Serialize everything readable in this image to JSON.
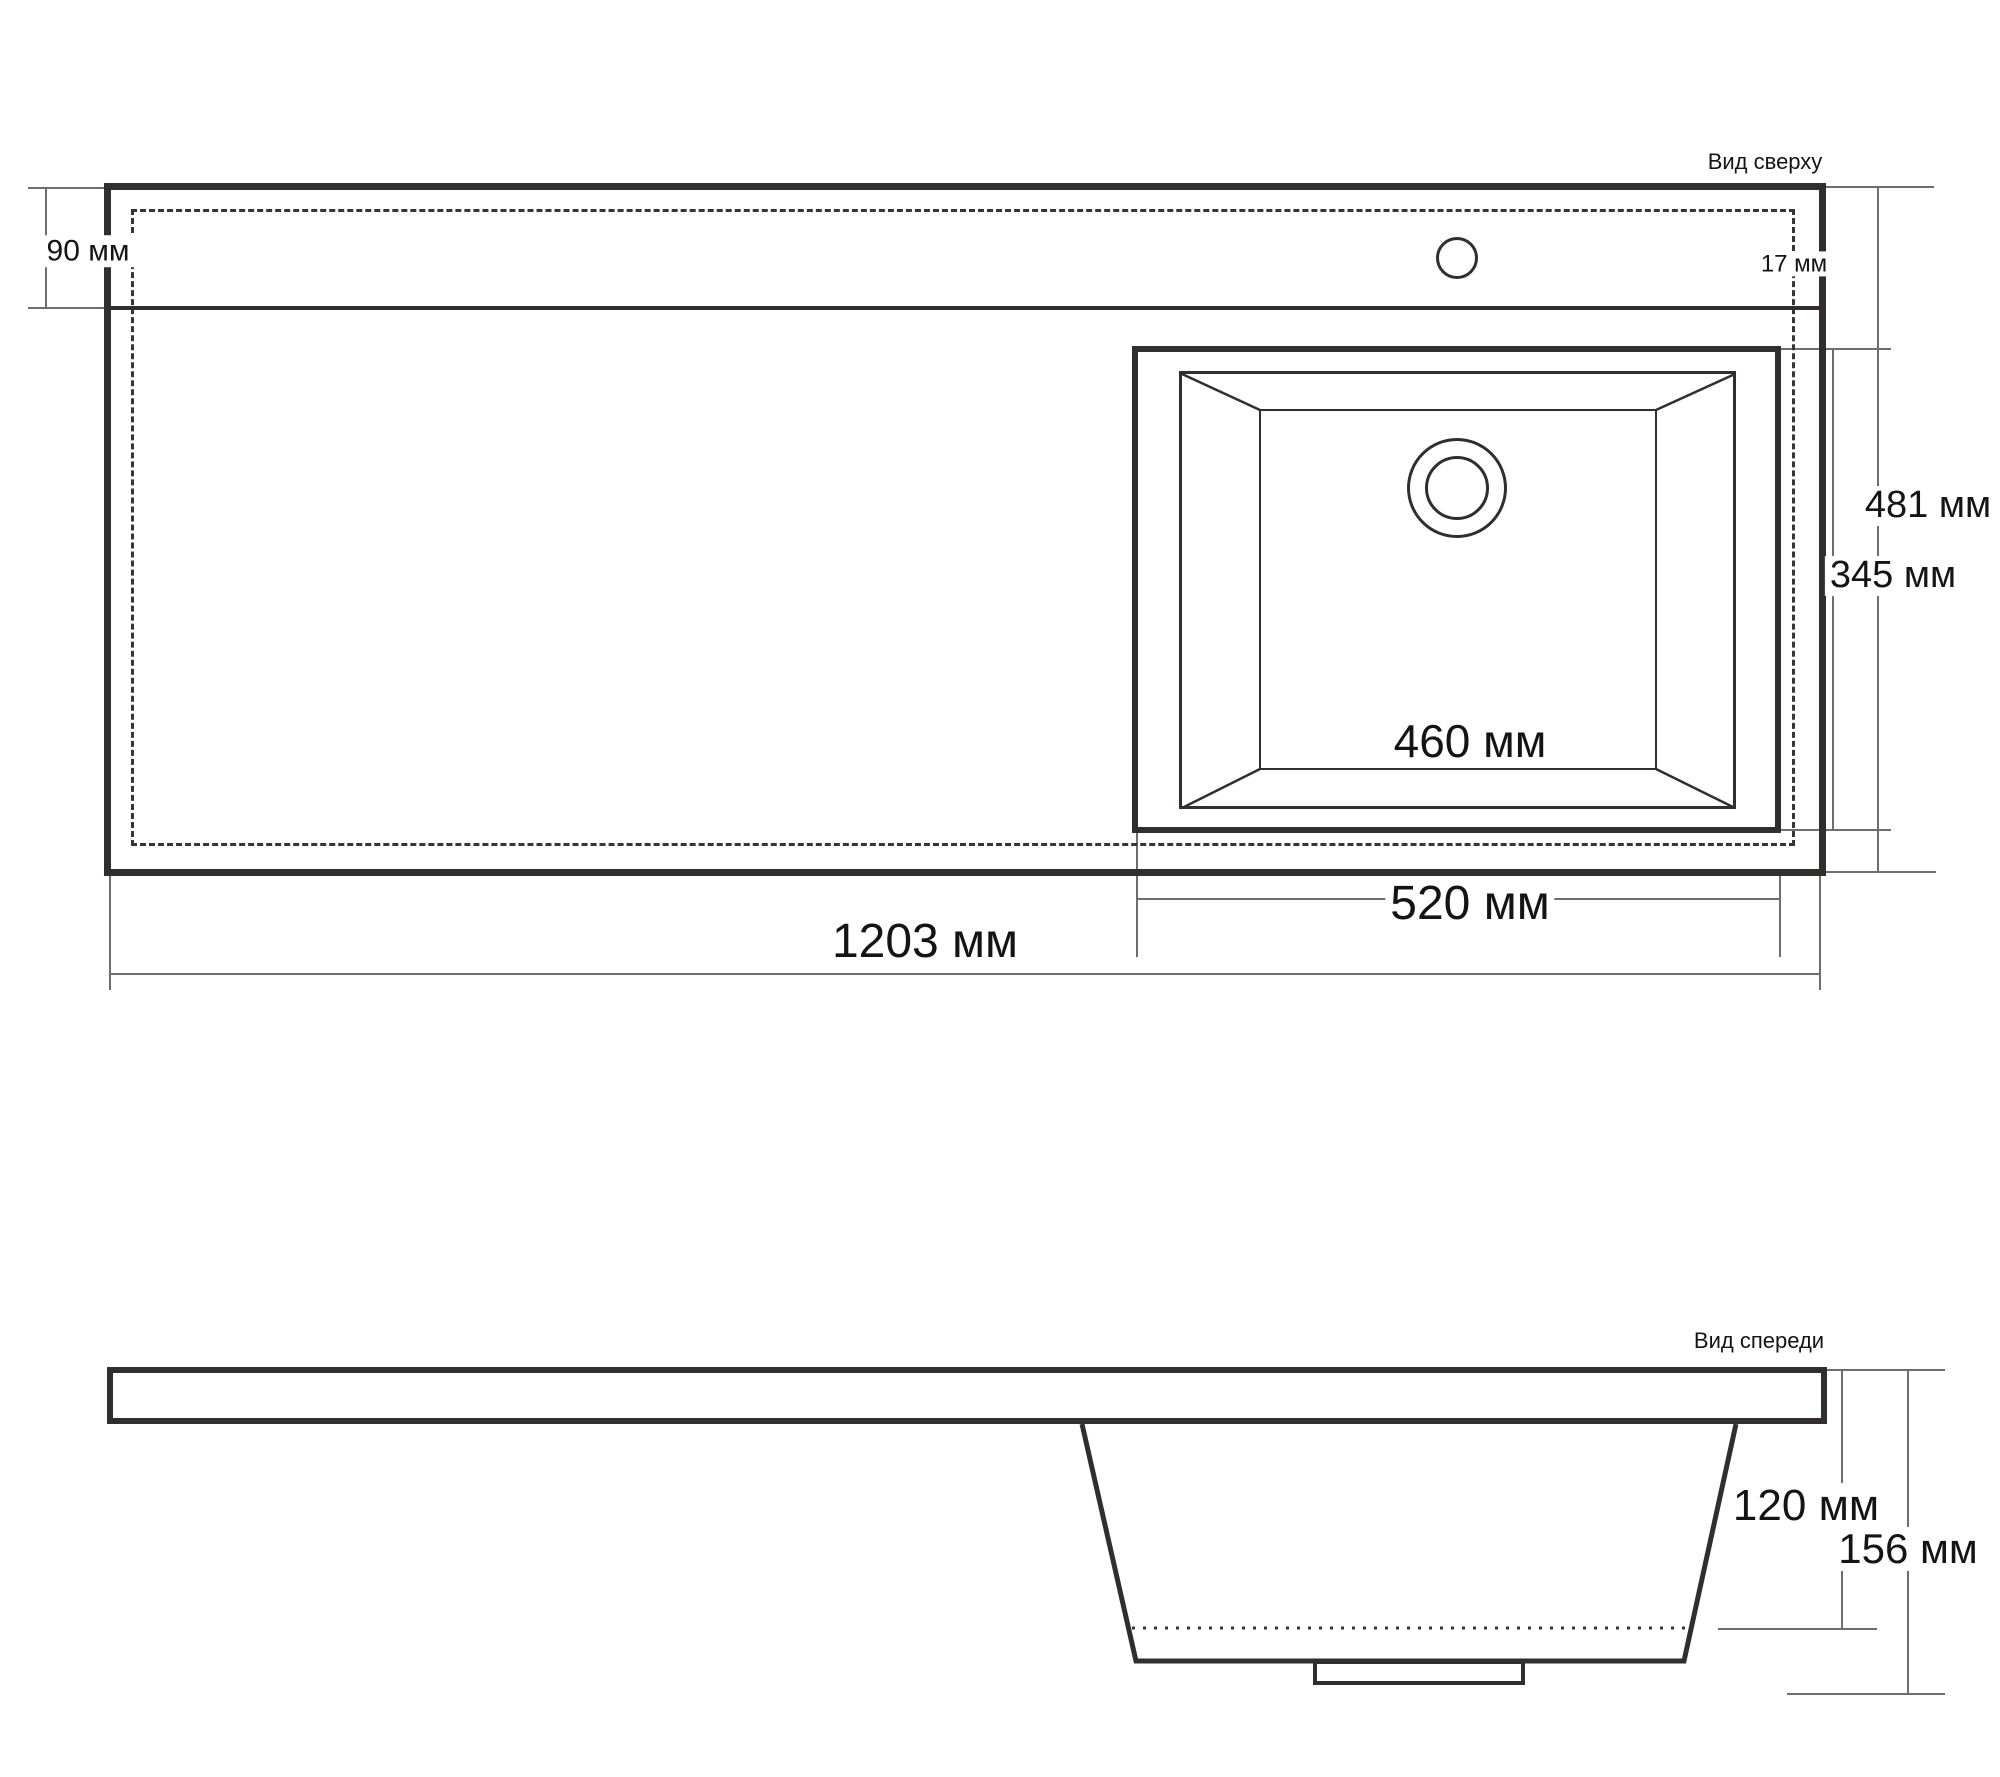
{
  "top_view": {
    "title": "Вид сверху",
    "dims": {
      "deck_depth": "90 мм",
      "rim_offset": "17 мм",
      "overall_depth": "481 мм",
      "sink_outer_depth": "345 мм",
      "bowl_inner_width": "460 мм",
      "sink_outer_width": "520 мм",
      "overall_width": "1203 мм"
    }
  },
  "front_view": {
    "title": "Вид спереди",
    "dims": {
      "bowl_depth": "120 мм",
      "overall_height": "156 мм"
    }
  },
  "colors": {
    "drawing_line": "#332e2e",
    "dimension_line": "#6e6e6e",
    "background": "#ffffff",
    "text": "#141414"
  }
}
